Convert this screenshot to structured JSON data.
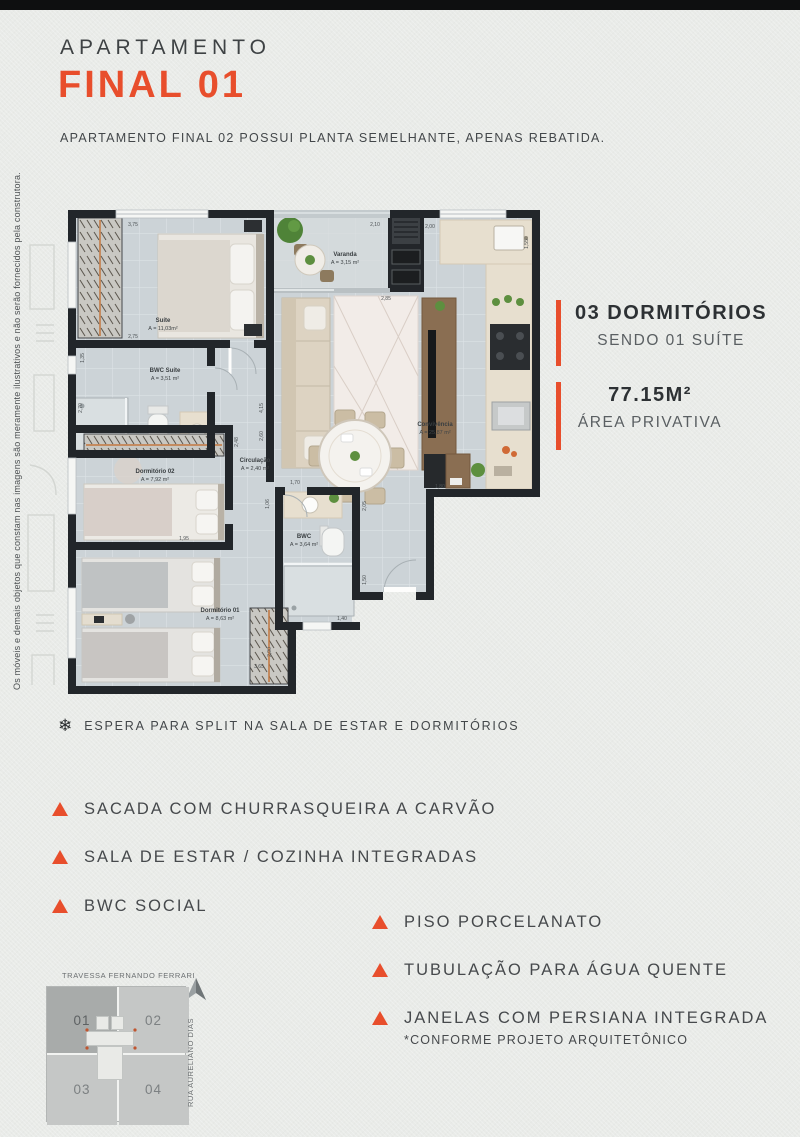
{
  "page": {
    "title_line1": "APARTAMENTO",
    "title_line2": "FINAL 01",
    "subtitle": "APARTAMENTO FINAL 02 POSSUI PLANTA SEMELHANTE, APENAS REBATIDA.",
    "side_disclaimer": "Os móveis e demais objetos que constam nas imagens são meramente ilustrativos e não serão fornecidos pela construtora.",
    "accent_color": "#E84E2C"
  },
  "info_blocks": [
    {
      "line1": "03 DORMITÓRIOS",
      "line2": "SENDO 01 SUÍTE"
    },
    {
      "line1": "77.15M²",
      "line2": "ÁREA PRIVATIVA"
    }
  ],
  "split_note": {
    "icon": "snowflake-icon",
    "symbol": "❄",
    "text": "ESPERA PARA SPLIT NA SALA DE ESTAR E DORMITÓRIOS"
  },
  "features_left": [
    {
      "label": "SACADA COM CHURRASQUEIRA A CARVÃO"
    },
    {
      "label": "SALA DE ESTAR / COZINHA INTEGRADAS"
    },
    {
      "label": "BWC SOCIAL"
    }
  ],
  "features_right": [
    {
      "label": "PISO PORCELANATO",
      "note": ""
    },
    {
      "label": "TUBULAÇÃO PARA ÁGUA QUENTE",
      "note": ""
    },
    {
      "label": "JANELAS COM PERSIANA INTEGRADA",
      "note": "*CONFORME PROJETO ARQUITETÔNICO"
    }
  ],
  "floorplan": {
    "rooms": [
      {
        "name": "Suíte",
        "area": "A = 11,03m²"
      },
      {
        "name": "Varanda",
        "area": "A = 3,15 m²"
      },
      {
        "name": "BWC Suíte",
        "area": "A = 3,51 m²"
      },
      {
        "name": "Dormitório 02",
        "area": "A = 7,92 m²"
      },
      {
        "name": "Circulação",
        "area": "A = 2,40 m²"
      },
      {
        "name": "Convivência",
        "area": "A = 25,87 m²"
      },
      {
        "name": "BWC",
        "area": "A = 3,64 m²"
      },
      {
        "name": "Dormitório 01",
        "area": "A = 8,63 m²"
      }
    ],
    "dimensions": [
      "3,75",
      "2,75",
      "2,10",
      "2,00",
      "1,55",
      "2,85",
      "1,35",
      "2,70",
      "2,48",
      "1,95",
      "1,70",
      "1,06",
      "2,05",
      "1,80",
      "1,50",
      "1,40",
      "2,90",
      "3,65",
      "4,15",
      "2,60"
    ]
  },
  "keyplan": {
    "street_top": "TRAVESSA FERNANDO FERRARI",
    "street_right": "RUA AURELIANO DIAS",
    "north_label": "N",
    "units": [
      {
        "label": "01",
        "highlight": true
      },
      {
        "label": "02",
        "highlight": false
      },
      {
        "label": "03",
        "highlight": false
      },
      {
        "label": "04",
        "highlight": false
      }
    ]
  }
}
